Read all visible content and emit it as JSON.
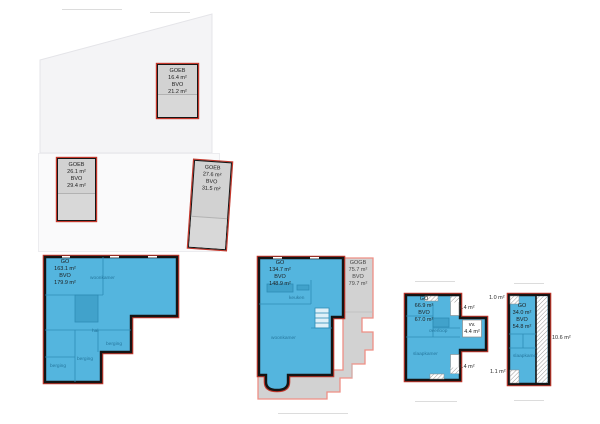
{
  "colors": {
    "blue": "#54b5de",
    "dark_blue": "#3f9fc9",
    "line_blue": "#2e8db6",
    "gray": "#d2d2d2",
    "outline_black": "#141414",
    "outline_red": "#c4372b",
    "outline_salmon": "#ef8f85",
    "pale": "#f4f4f6"
  },
  "attic": {
    "boxes": [
      {
        "title": "GOEB",
        "area": "16.4 m²",
        "bvo_title": "BVO",
        "bvo": "21.2 m²"
      },
      {
        "title": "GOEB",
        "area": "26.1 m²",
        "bvo_title": "BVO",
        "bvo": "29.4 m²"
      },
      {
        "title": "GOEB",
        "area": "27.6 m²",
        "bvo_title": "BVO",
        "bvo": "31.5 m²"
      }
    ]
  },
  "ground_floor": {
    "title": "GO",
    "area": "163.1 m²",
    "bvo_title": "BVO",
    "bvo": "179.9 m²",
    "rooms": {
      "living": "woonkamer",
      "hall": "hal",
      "storage1": "berging",
      "storage2": "berging",
      "storage3": "berging"
    }
  },
  "first_floor": {
    "title": "GO",
    "area": "134.7 m²",
    "bvo_title": "BVO",
    "bvo": "148.9 m²",
    "gogb": {
      "title": "GOGB",
      "area": "75.7 m²",
      "bvo_title": "BVO",
      "bvo": "79.7 m²"
    },
    "rooms": {
      "kitchen": "keuken",
      "living": "woonkamer"
    }
  },
  "second_floor": {
    "title": "GO",
    "area": "66.9 m²",
    "bvo_title": "BVO",
    "bvo": "67.0 m²",
    "void_label": "vv.",
    "void_area": "4.4 m²",
    "balcony_top": "1.4 m²",
    "balcony_bottom": "1.4 m²",
    "rooms": {
      "landing": "overloop",
      "bedroom": "slaapkamer"
    }
  },
  "third_floor": {
    "title": "GO",
    "area": "34.0 m²",
    "bvo_title": "BVO",
    "bvo": "54.8 m²",
    "dormer_top": "1.0 m²",
    "dormer_bottom": "1.1 m²",
    "terrace": "10.6 m²",
    "rooms": {
      "bedroom": "slaapkamer"
    }
  }
}
